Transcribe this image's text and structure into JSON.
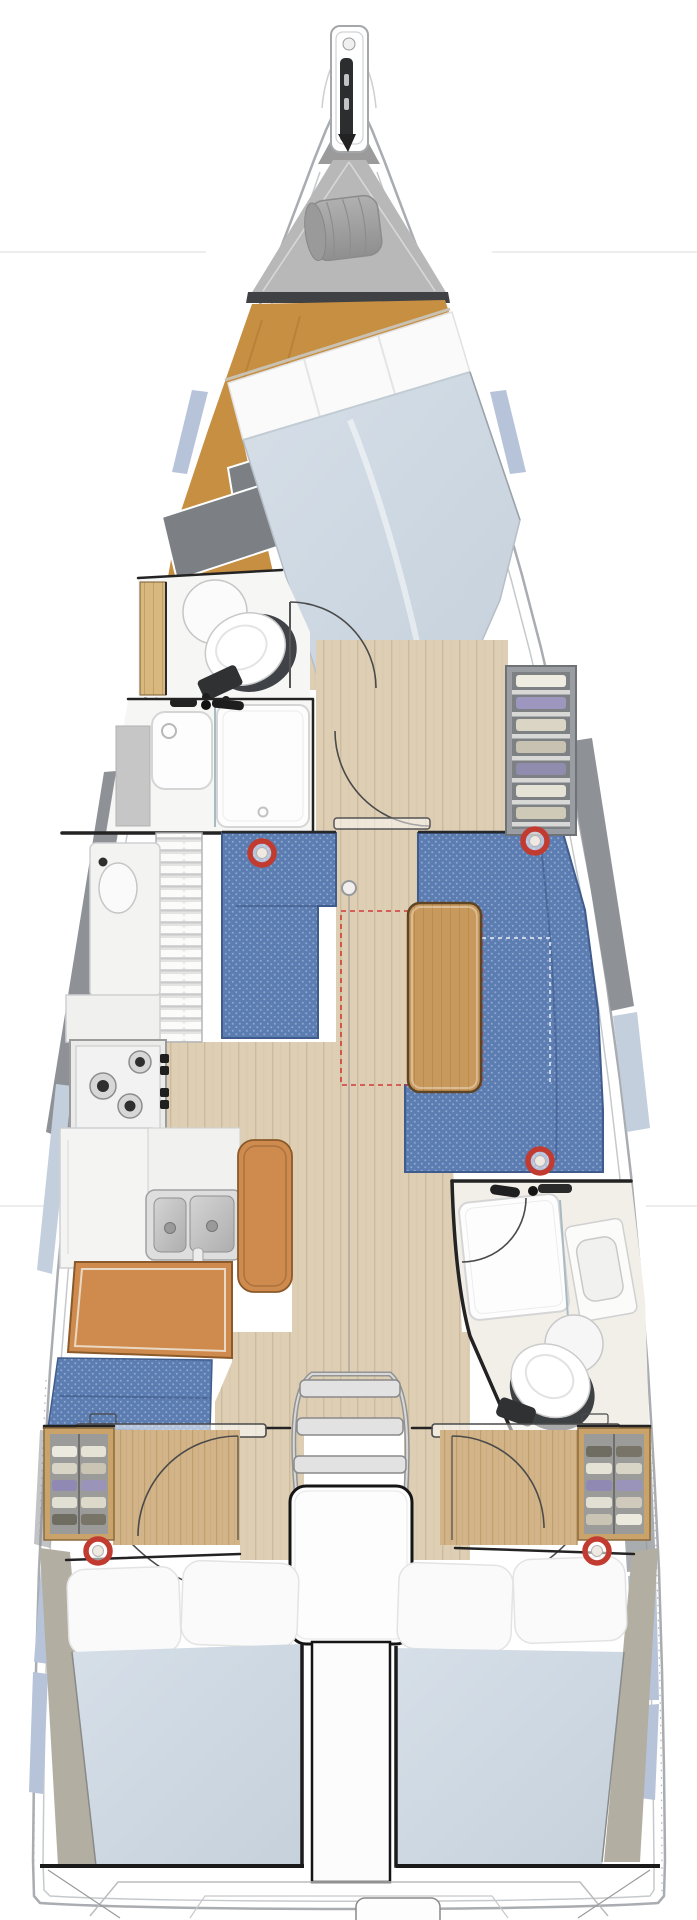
{
  "meta": {
    "title": "Sailboat interior deck plan, top view",
    "canvas_width": 697,
    "canvas_height": 1920,
    "visible_text": "none"
  },
  "colors": {
    "hull_line": "#a9acb0",
    "hull_inner_line": "#c6c9cc",
    "deck_gray": "#b8b8b8",
    "deck_gray_dark": "#9b9b9b",
    "sailbag_gray": "#a2a2a2",
    "bulkhead_dark": "#3f4144",
    "sole_orange": "#c78f42",
    "floor_plank": "#decfb4",
    "floor_plank_line": "#ccbb9e",
    "wood_panel": "#d3b488",
    "wood_panel_line": "#c09f6e",
    "door_wood": "#d9b87e",
    "upholstery_blue": "#5c7db2",
    "upholstery_blue_dot": "#8fa7cd",
    "upholstery_blue_edge": "#3f5c8c",
    "mattress_blue": "#cdd7e1",
    "pillow_white": "#fafafa",
    "quilt_gray": "#7c8084",
    "hullband_gray": "#8e9196",
    "window_blue": "#b6c3d9",
    "window_blue_light": "#c4cfdd",
    "leather_tan": "#cf8b4e",
    "table_wood": "#c8995c",
    "table_wood_line": "#b9854a",
    "room_white": "#f6f6f4",
    "fixture_white": "#fdfdfd",
    "fixture_line": "#d5d5d5",
    "steel_gray": "#dedede",
    "steel_line": "#9fa0a2",
    "wall_dark": "#232323",
    "frame_black": "#151515",
    "marker_red": "#c23b31",
    "arc_line": "#4a4a4a",
    "dash_red": "#cf3a3a",
    "khaki_wedge": "#b2aea2",
    "locker_frame_wood": "#caa36a",
    "locker_interior": "#9b9b99"
  },
  "areas": [
    {
      "id": "hull",
      "label": "Hull outline with side decks and hull windows"
    },
    {
      "id": "bowsprit",
      "label": "Bowsprit with anchor roller and windlass"
    },
    {
      "id": "sail-locker",
      "label": "Forepeak sail locker with stowed sail bag"
    },
    {
      "id": "forward-cabin",
      "label": "Forward owner's cabin with angled island double berth"
    },
    {
      "id": "forward-head",
      "label": "Forward head toilet compartment"
    },
    {
      "id": "forward-shower",
      "label": "Forward shower room with washbasin"
    },
    {
      "id": "starboard-wardrobe",
      "label": "Starboard shelved wardrobe"
    },
    {
      "id": "saloon",
      "label": "Saloon with port settee, starboard L-shaped settee and wooden table"
    },
    {
      "id": "galley",
      "label": "Port linear galley with 3-burner stove, twin sinks and refrigerator"
    },
    {
      "id": "nav-station",
      "label": "Chart table with navigator bench seat"
    },
    {
      "id": "aft-head",
      "label": "Starboard aft head with shower, vanity and toilet"
    },
    {
      "id": "companionway",
      "label": "Companionway steps over engine compartment"
    },
    {
      "id": "port-aft-cabin",
      "label": "Port aft double cabin with shelved locker"
    },
    {
      "id": "starboard-aft-cabin",
      "label": "Starboard aft double cabin with shelved locker"
    },
    {
      "id": "transom",
      "label": "Transom with swim platform"
    }
  ],
  "markers": {
    "type": "deck-hatch-marker",
    "count": 5,
    "positions": [
      [
        262,
        853
      ],
      [
        535,
        841
      ],
      [
        540,
        1161
      ],
      [
        98,
        1551
      ],
      [
        597,
        1551
      ]
    ]
  },
  "table_extension_outline": {
    "x": 341,
    "y": 911,
    "width": 141,
    "height": 174
  }
}
